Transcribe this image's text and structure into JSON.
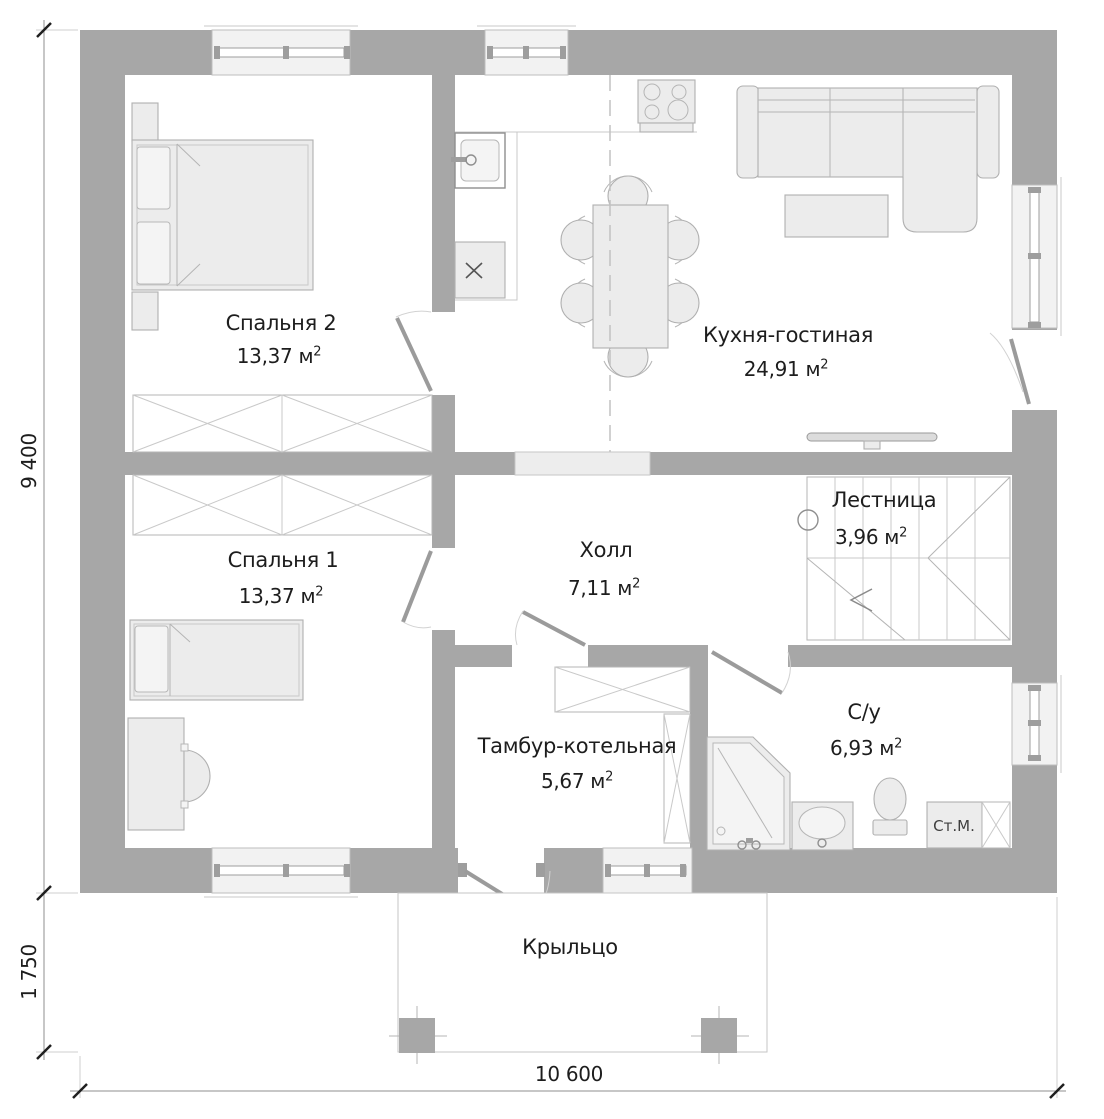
{
  "plan": {
    "rooms": [
      {
        "name": "Спальня 2",
        "area": "13,37",
        "unit": "м",
        "sup": "2"
      },
      {
        "name": "Кухня-гостиная",
        "area": "24,91",
        "unit": "м",
        "sup": "2"
      },
      {
        "name": "Спальня 1",
        "area": "13,37",
        "unit": "м",
        "sup": "2"
      },
      {
        "name": "Холл",
        "area": "7,11",
        "unit": "м",
        "sup": "2"
      },
      {
        "name": "Лестница",
        "area": "3,96",
        "unit": "м",
        "sup": "2"
      },
      {
        "name": "Тамбур-котельная",
        "area": "5,67",
        "unit": "м",
        "sup": "2"
      },
      {
        "name": "С/у",
        "area": "6,93",
        "unit": "м",
        "sup": "2"
      },
      {
        "name": "Крыльцо"
      }
    ],
    "appliances": {
      "washing_machine": "Ст.М."
    },
    "dimensions": {
      "height": "9 400",
      "porch_height": "1 750",
      "width": "10 600"
    },
    "colors": {
      "wall": "#a7a7a7",
      "furn_fill": "#ececec",
      "furn_stroke": "#b0b0b0",
      "text": "#1d1d1d"
    }
  }
}
